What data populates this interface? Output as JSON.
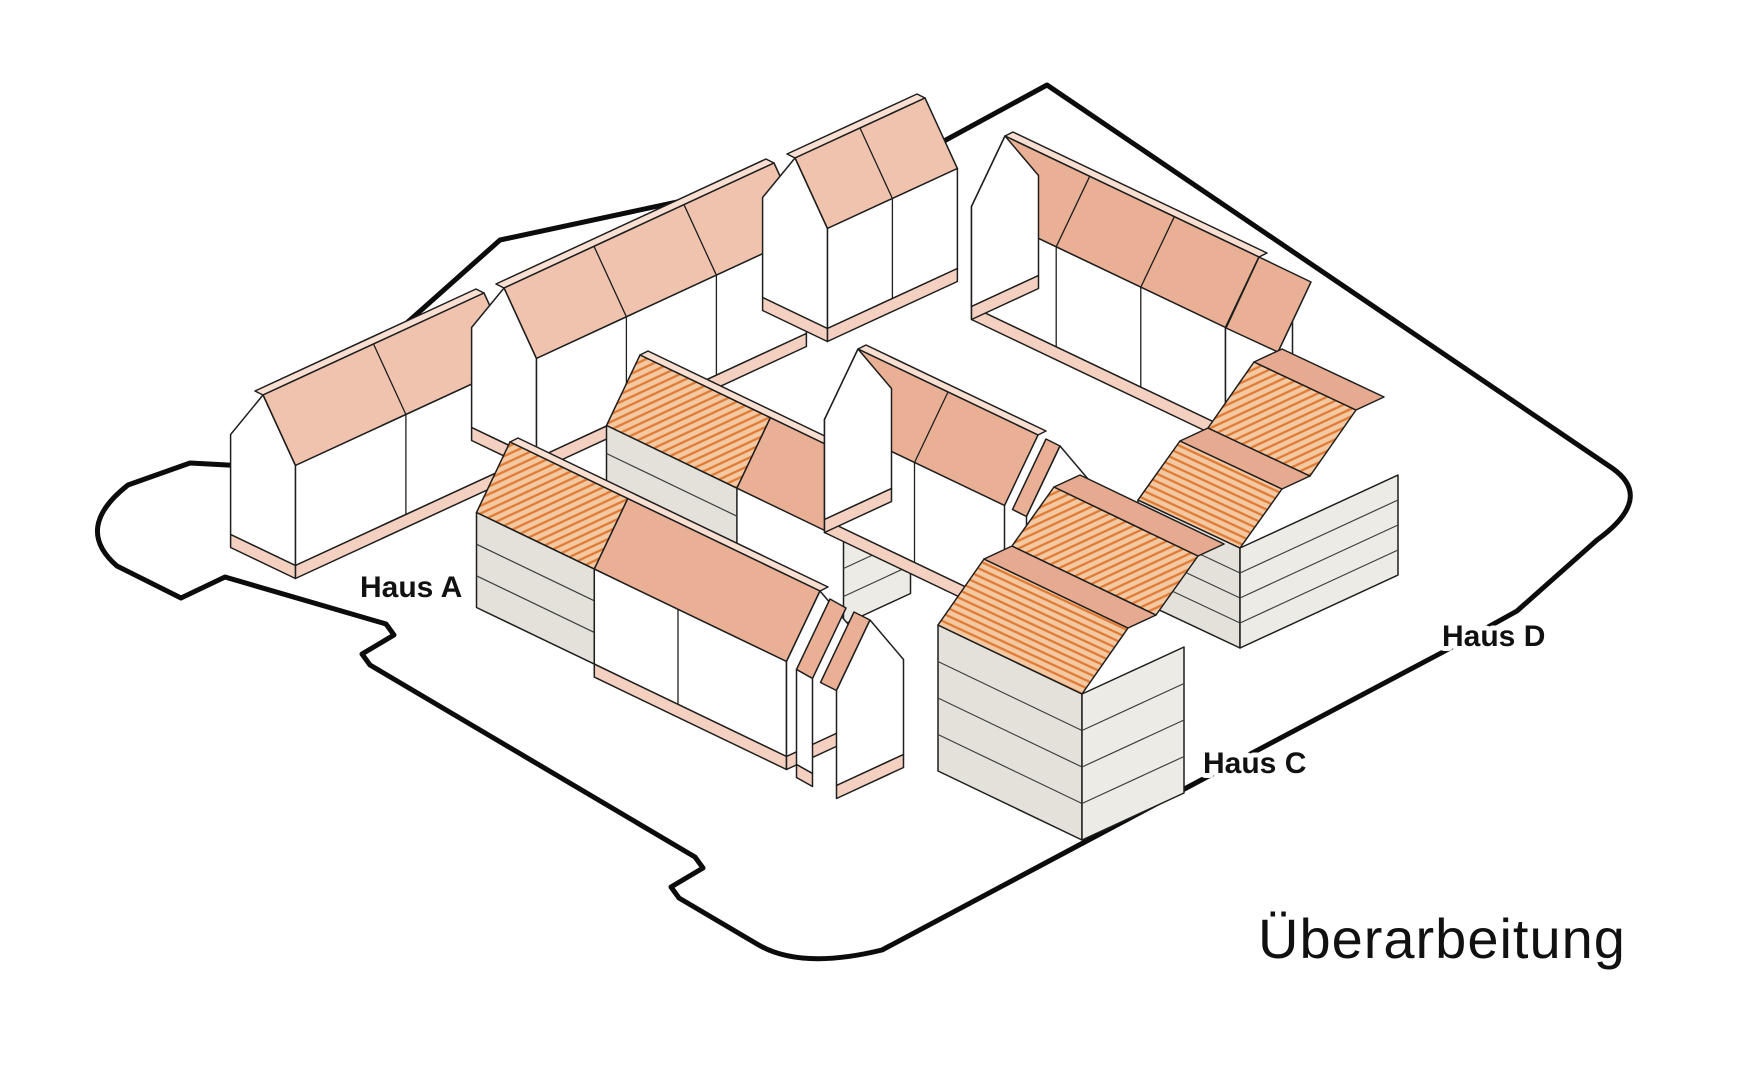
{
  "title": "Überarbeitung",
  "labels": {
    "haus_a": "Haus A",
    "haus_c": "Haus C",
    "haus_d": "Haus D"
  },
  "legend_note": "axonometric massing diagram of four housing rows inside a parcel boundary",
  "colors": {
    "background": "#ffffff",
    "outline": "#1e1e1e",
    "boundary": "#0c0c0c",
    "roof_salmon": "#efc3ae",
    "roof_salmon_dark": "#e9b096",
    "roof_flat": "#e6aa90",
    "ridge_sliver": "#f8dfd2",
    "wall_white": "#ffffff",
    "wall_grey": "#e4e1da",
    "wall_grey_light": "#edebe5",
    "plinth": "#f4d0c0",
    "hatch_bg": "#f3c9a3",
    "hatch_line": "#e17a32",
    "floor_line": "#3f3f3f",
    "label": "#111111"
  }
}
